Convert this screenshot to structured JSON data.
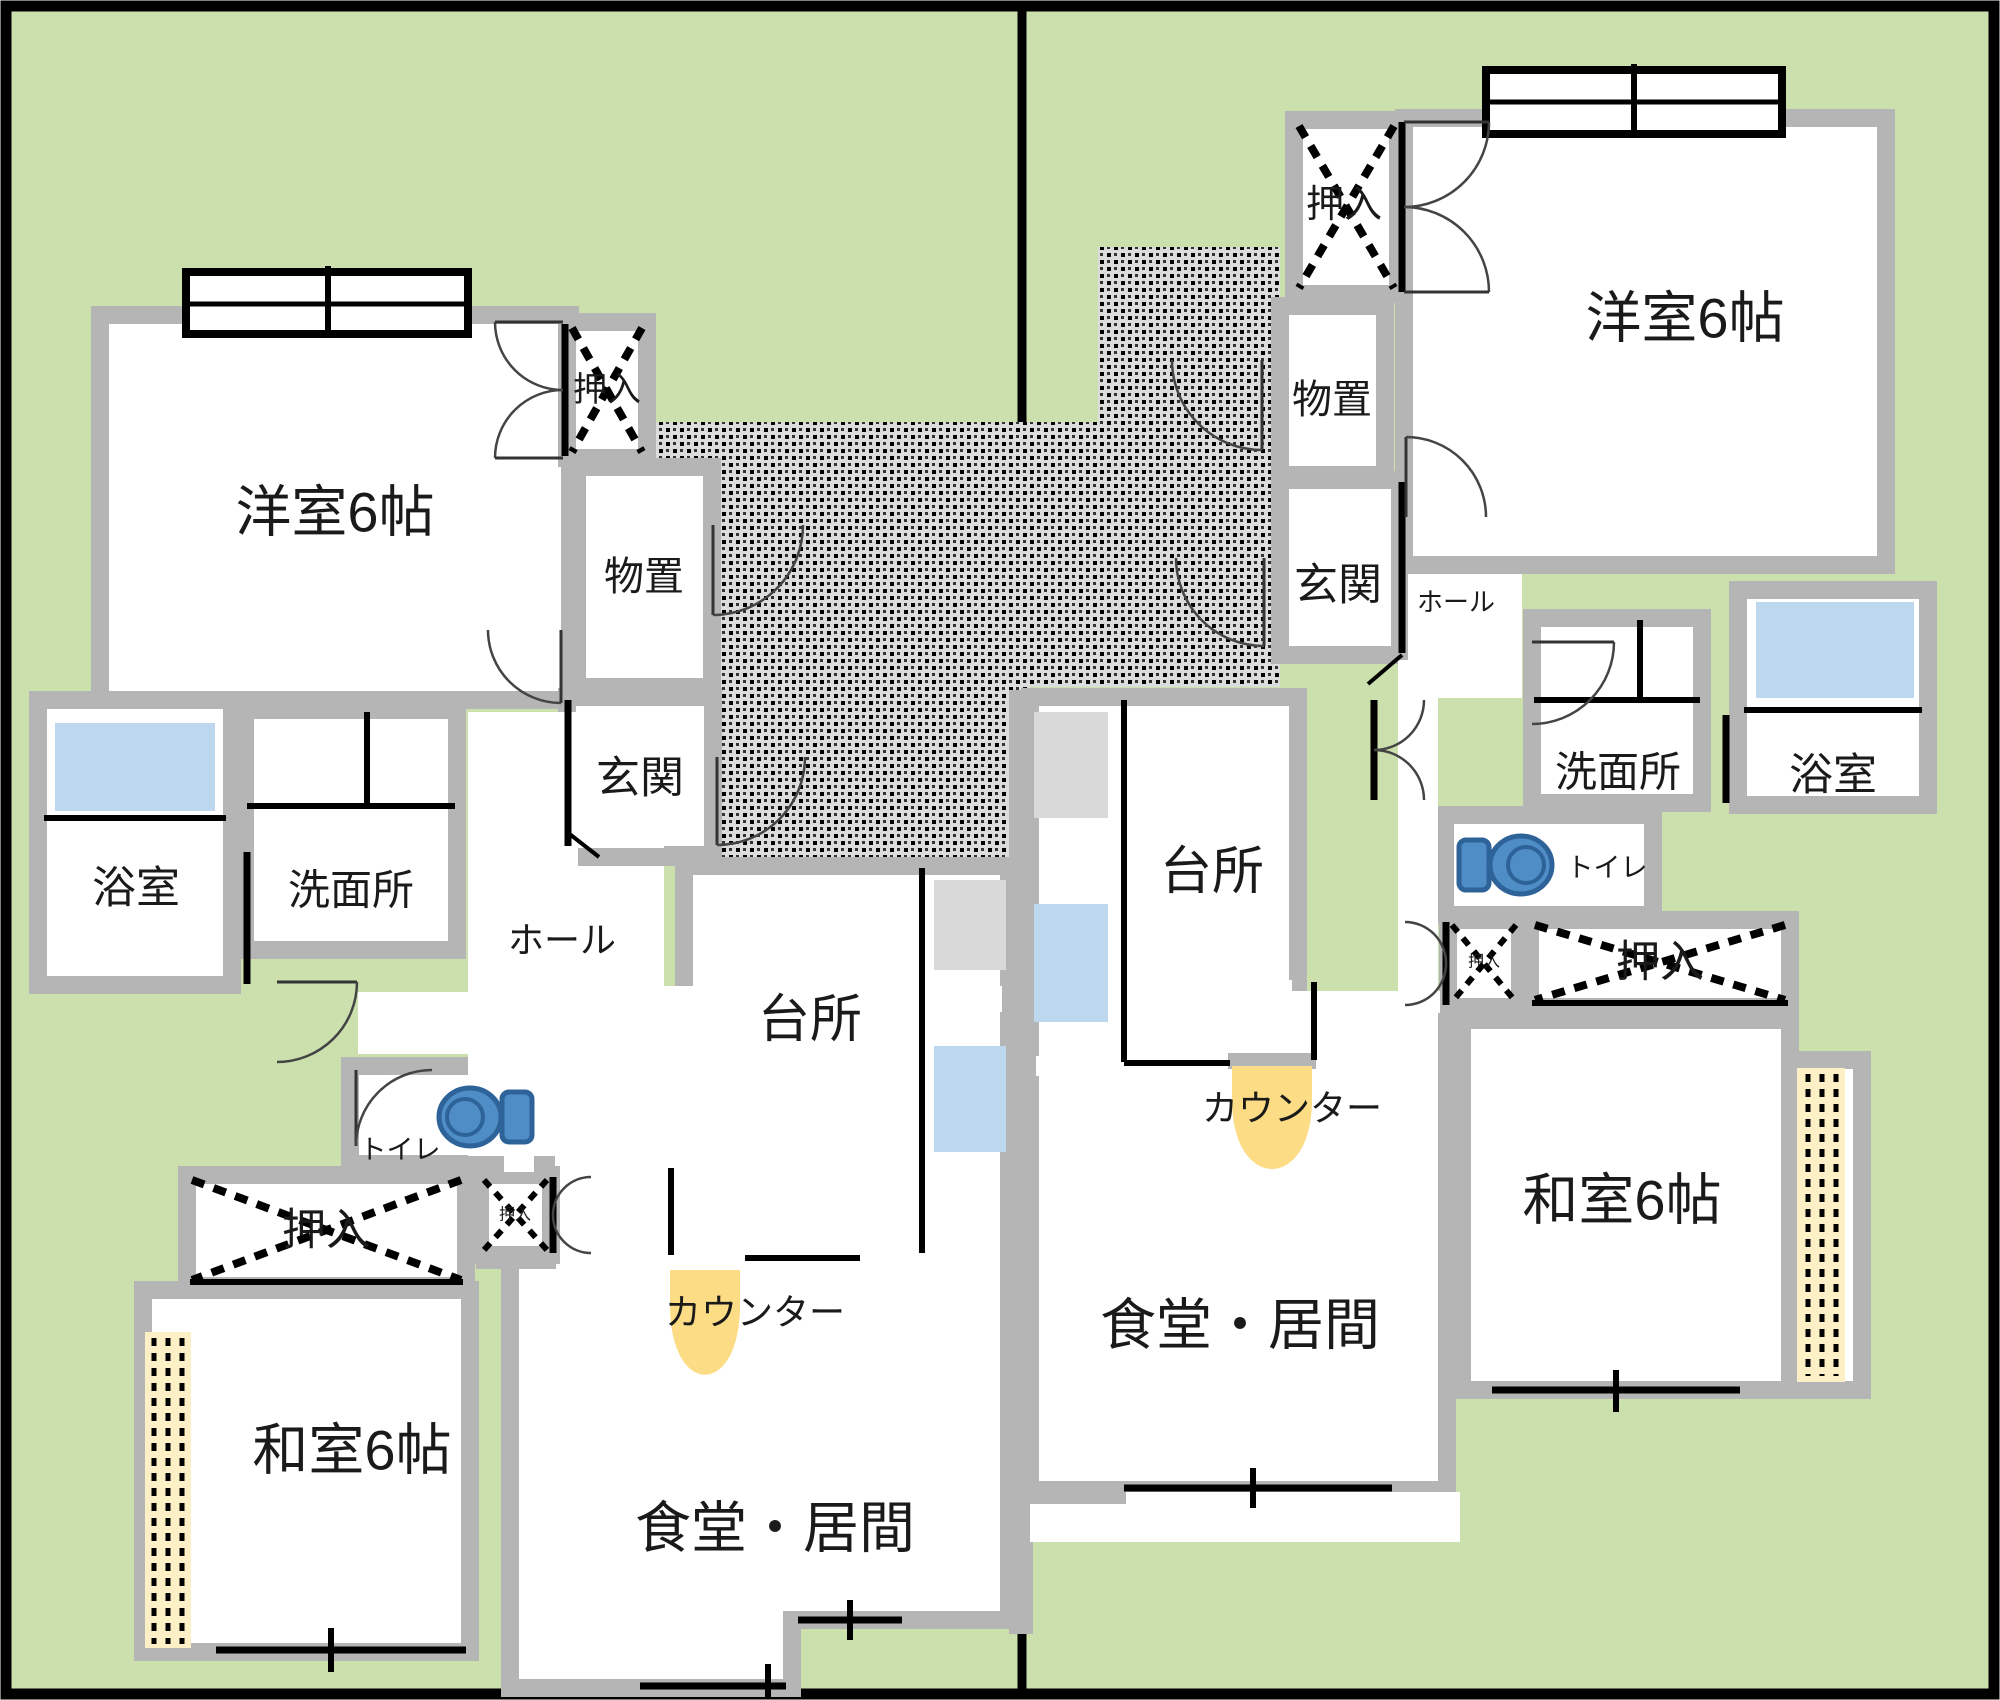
{
  "colors": {
    "lawn": "#cbe0ad",
    "wall": "#b5b5b5",
    "line": "#000000",
    "hatch_bg": "#dcdcdc",
    "tatami": "#fdf0c6",
    "tub": "#bdd7ee",
    "toilet": "#4e8dc6",
    "toilet_dark": "#2d6399",
    "counter": "#fcdc84",
    "fixture": "#d9d9d9",
    "fixture_blue": "#bdd7ee"
  },
  "units": {
    "left": {
      "name": "left-unit",
      "rooms": {
        "western": {
          "label": "洋室6帖"
        },
        "closet_top": {
          "label": "押入"
        },
        "storage": {
          "label": "物置"
        },
        "entrance": {
          "label": "玄関"
        },
        "hall": {
          "label": "ホール"
        },
        "bath": {
          "label": "浴室"
        },
        "washroom": {
          "label": "洗面所"
        },
        "toilet": {
          "label": "トイレ"
        },
        "kitchen": {
          "label": "台所"
        },
        "counter": {
          "label": "カウンター"
        },
        "dining": {
          "label": "食堂・居間"
        },
        "closet_large": {
          "label": "押入"
        },
        "closet_small": {
          "label": "押入"
        },
        "japanese": {
          "label": "和室6帖"
        }
      }
    },
    "right": {
      "name": "right-unit",
      "rooms": {
        "western": {
          "label": "洋室6帖"
        },
        "closet_top": {
          "label": "押入"
        },
        "storage": {
          "label": "物置"
        },
        "entrance": {
          "label": "玄関"
        },
        "hall": {
          "label": "ホール"
        },
        "bath": {
          "label": "浴室"
        },
        "washroom": {
          "label": "洗面所"
        },
        "toilet": {
          "label": "トイレ"
        },
        "kitchen": {
          "label": "台所"
        },
        "counter": {
          "label": "カウンター"
        },
        "dining": {
          "label": "食堂・居間"
        },
        "closet_large": {
          "label": "押入"
        },
        "closet_small": {
          "label": "押入"
        },
        "japanese": {
          "label": "和室6帖"
        }
      }
    }
  }
}
